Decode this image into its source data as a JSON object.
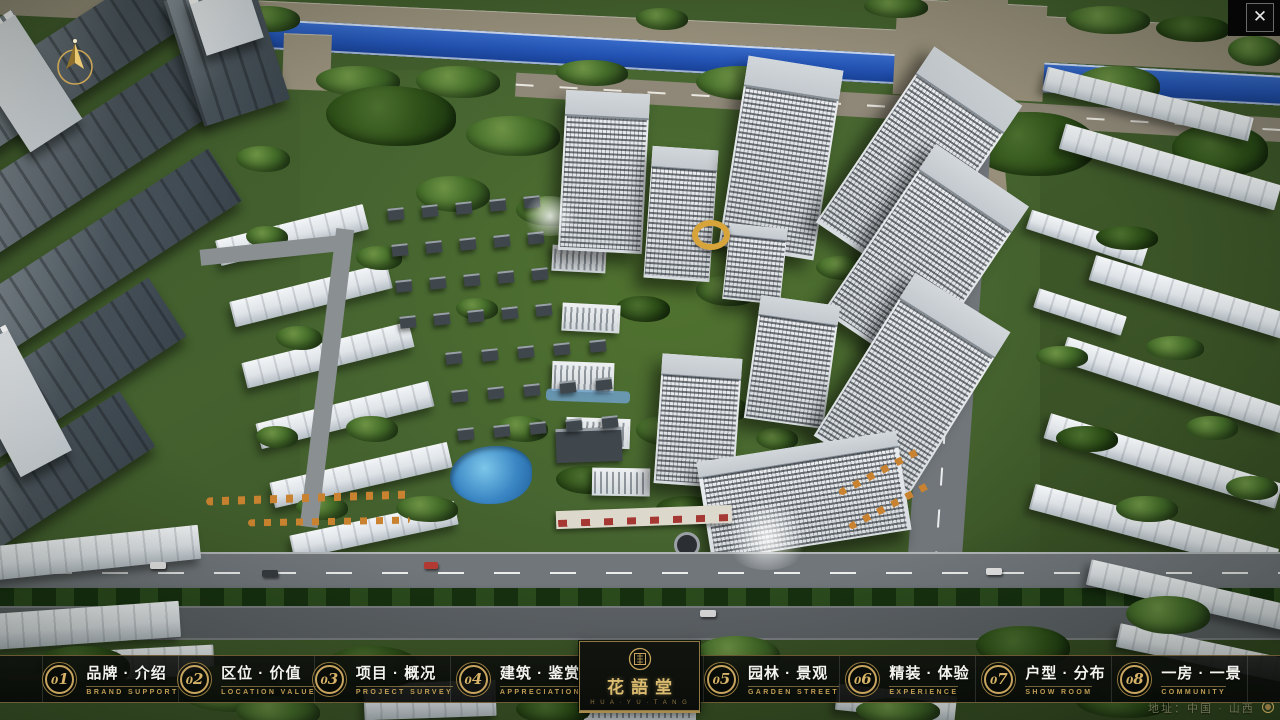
{
  "window": {
    "close_symbol": "✕"
  },
  "nav": {
    "items": [
      {
        "num": "01",
        "zh": "品牌 · 介绍",
        "en": "BRAND SUPPORT"
      },
      {
        "num": "02",
        "zh": "区位 · 价值",
        "en": "LOCATION VALUE"
      },
      {
        "num": "03",
        "zh": "项目 · 概况",
        "en": "PROJECT SURVEY"
      },
      {
        "num": "04",
        "zh": "建筑 · 鉴赏",
        "en": "APPRECIATION"
      },
      {
        "num": "05",
        "zh": "园林 · 景观",
        "en": "GARDEN STREET"
      },
      {
        "num": "06",
        "zh": "精装 · 体验",
        "en": "EXPERIENCE"
      },
      {
        "num": "07",
        "zh": "户型 · 分布",
        "en": "SHOW ROOM"
      },
      {
        "num": "08",
        "zh": "一房 · 一景",
        "en": "COMMUNITY"
      }
    ]
  },
  "logo": {
    "title": "花語堂",
    "subtitle": "H U A · Y U · T A N G"
  },
  "footer": {
    "address": "地址：中国 · 山西"
  },
  "colors": {
    "gold": "#c9a55e",
    "bar_bg": "#0a0c0a",
    "river": "#2353b4"
  }
}
